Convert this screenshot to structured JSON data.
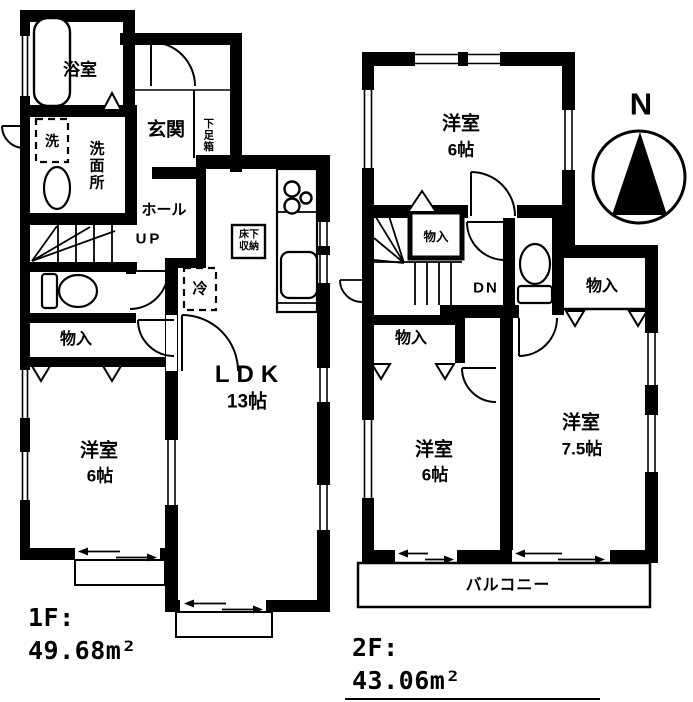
{
  "colors": {
    "ink": "#000000",
    "paper": "#ffffff"
  },
  "floor1": {
    "area": {
      "line1": "1F:",
      "line2": "49.68m²"
    },
    "labels": {
      "bath": "浴室",
      "washer": "洗",
      "washroom": "洗面所",
      "entrance": "玄関",
      "shoe_box": "下足箱",
      "hall": "ホール",
      "up": "UP",
      "storage": "物入",
      "bedroom_name": "洋室",
      "bedroom_size": "6帖",
      "ldk_name": "LDK",
      "ldk_size": "13帖",
      "floor_storage_line1": "床下",
      "floor_storage_line2": "収納",
      "fridge": "冷"
    }
  },
  "floor2": {
    "area": {
      "line1": "2F:",
      "line2": "43.06m²"
    },
    "labels": {
      "bedroom_north_name": "洋室",
      "bedroom_north_size": "6帖",
      "storage_by_stairs": "物入",
      "down": "DN",
      "storage_east": "物入",
      "storage_west": "物入",
      "bedroom_sw_name": "洋室",
      "bedroom_sw_size": "6帖",
      "bedroom_se_name": "洋室",
      "bedroom_se_size": "7.5帖",
      "balcony": "バルコニー"
    }
  },
  "compass": {
    "north": "N"
  }
}
